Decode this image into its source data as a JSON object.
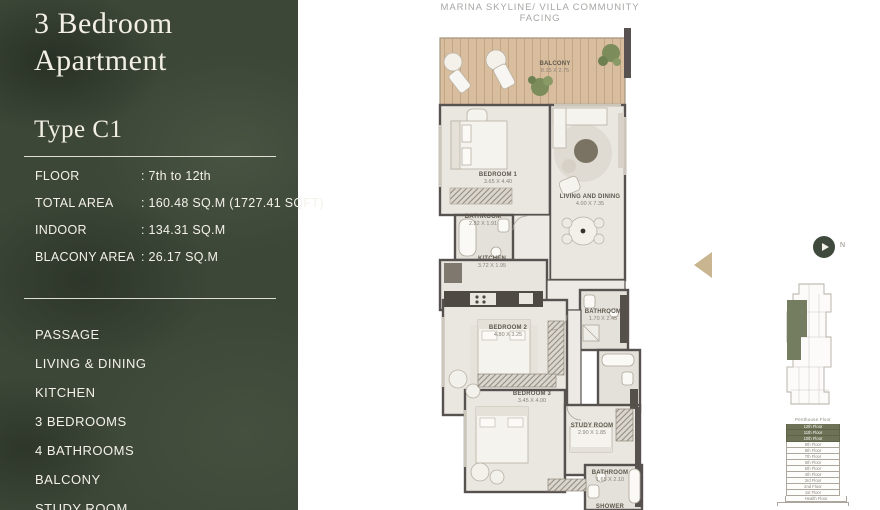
{
  "page": {
    "heading": "MARINA SKYLINE/ VILLA COMMUNITY FACING"
  },
  "sidebar": {
    "title": "3 Bedroom Apartment",
    "type_label": "Type C1",
    "specs": [
      {
        "label": "FLOOR",
        "value": ": 7th to 12th"
      },
      {
        "label": "TOTAL AREA",
        "value": ": 160.48 SQ.M (1727.41 SQFT)"
      },
      {
        "label": "INDOOR",
        "value": ": 134.31 SQ.M"
      },
      {
        "label": "BLACONY AREA",
        "value": ": 26.17 SQ.M"
      }
    ],
    "features": [
      "PASSAGE",
      "LIVING & DINING",
      "KITCHEN",
      "3 BEDROOMS",
      "4 BATHROOMS",
      "BALCONY",
      "STUDY ROOM"
    ]
  },
  "plan": {
    "rooms": [
      {
        "name": "BALCONY",
        "dims": "8.15 X 2.75"
      },
      {
        "name": "BEDROOM 1",
        "dims": "3.65 X 4.40"
      },
      {
        "name": "LIVING AND DINING",
        "dims": "4.00 X 7.35"
      },
      {
        "name": "BATHROOM",
        "dims": "2.82 X 1.91"
      },
      {
        "name": "KITCHEN",
        "dims": "3.72 X 1.95"
      },
      {
        "name": "BATHROOM",
        "dims": "1.70 X 2.45"
      },
      {
        "name": "BEDROOM 2",
        "dims": "4.80 X 3.25"
      },
      {
        "name": "BEDROOM 3",
        "dims": "3.45 X 4.00"
      },
      {
        "name": "STUDY ROOM",
        "dims": "2.90 X 1.85"
      },
      {
        "name": "BATHROOM",
        "dims": "1.65 X 2.10"
      },
      {
        "name": "SHOWER",
        "dims": ""
      }
    ]
  },
  "compass": {
    "label": "N"
  },
  "floor_stack": {
    "header": "Penthouse Floor",
    "floors": [
      {
        "label": "12th Floor",
        "highlighted": true
      },
      {
        "label": "11th Floor",
        "highlighted": true
      },
      {
        "label": "10th Floor",
        "highlighted": true
      },
      {
        "label": "9th Floor",
        "highlighted": false
      },
      {
        "label": "8th Floor",
        "highlighted": false
      },
      {
        "label": "7th Floor",
        "highlighted": false
      },
      {
        "label": "6th Floor",
        "highlighted": false
      },
      {
        "label": "5th Floor",
        "highlighted": false
      },
      {
        "label": "4th Floor",
        "highlighted": false
      },
      {
        "label": "3rd Floor",
        "highlighted": false
      },
      {
        "label": "2nd Floor",
        "highlighted": false
      },
      {
        "label": "1st Floor",
        "highlighted": false
      },
      {
        "label": "Health Floor",
        "highlighted": false
      }
    ]
  },
  "colors": {
    "sidebar_green": "#3D4738",
    "cream_text": "#F2EFE5",
    "wood_deck": "#D8BD9E",
    "wall": "#57524F",
    "keyplan_highlight": "#757D60",
    "entry_arrow": "#C9B691"
  }
}
